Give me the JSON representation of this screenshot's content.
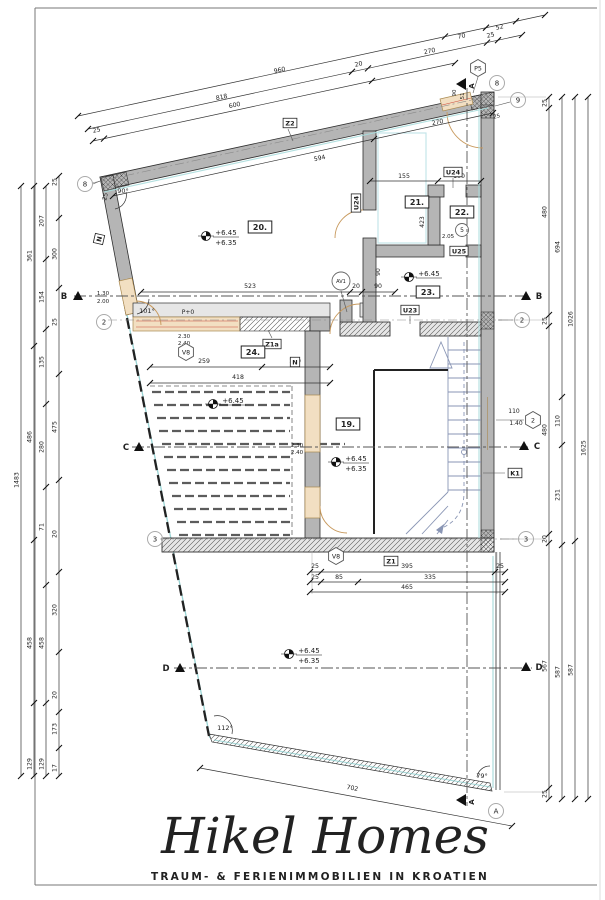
{
  "logo": {
    "name": "Hikel Homes",
    "tagline": "TRAUM- & FERIENIMMOBILIEN IN KROATIEN",
    "color": "#c6cc80"
  },
  "rooms": [
    {
      "t": "20.",
      "x": 260,
      "y": 227
    },
    {
      "t": "21.",
      "x": 417,
      "y": 202
    },
    {
      "t": "22.",
      "x": 462,
      "y": 212
    },
    {
      "t": "23.",
      "x": 428,
      "y": 292
    },
    {
      "t": "24.",
      "x": 253,
      "y": 352
    },
    {
      "t": "19.",
      "x": 348,
      "y": 424
    }
  ],
  "tag_boxes": [
    {
      "t": "Z2",
      "x": 290,
      "y": 123
    },
    {
      "t": "N",
      "x": 99,
      "y": 239,
      "r": -77
    },
    {
      "t": "U24",
      "x": 453,
      "y": 172
    },
    {
      "t": "U24",
      "x": 356,
      "y": 203,
      "r": -90
    },
    {
      "t": "U25",
      "x": 459,
      "y": 251
    },
    {
      "t": "U23",
      "x": 410,
      "y": 310
    },
    {
      "t": "Z1a",
      "x": 272,
      "y": 344
    },
    {
      "t": "N",
      "x": 295,
      "y": 362
    },
    {
      "t": "K1",
      "x": 515,
      "y": 473
    },
    {
      "t": "Z1",
      "x": 391,
      "y": 561
    }
  ],
  "bubbles": [
    {
      "t": "8",
      "x": 85,
      "y": 184
    },
    {
      "t": "8",
      "x": 497,
      "y": 83
    },
    {
      "t": "9",
      "x": 518,
      "y": 100
    },
    {
      "t": "2",
      "x": 104,
      "y": 322
    },
    {
      "t": "2",
      "x": 522,
      "y": 320
    },
    {
      "t": "3",
      "x": 155,
      "y": 539
    },
    {
      "t": "3",
      "x": 526,
      "y": 539
    },
    {
      "t": "A",
      "x": 496,
      "y": 811
    }
  ],
  "hexagons": [
    {
      "t": "P5",
      "x": 478,
      "y": 68
    },
    {
      "t": "V8",
      "x": 186,
      "y": 352
    },
    {
      "t": "V8",
      "x": 336,
      "y": 556
    },
    {
      "t": "2",
      "x": 533,
      "y": 420
    }
  ],
  "circles": [
    {
      "t": "5",
      "x": 462,
      "y": 230,
      "r": 6.5
    },
    {
      "t": "AV1",
      "x": 341,
      "y": 281,
      "r": 9
    }
  ],
  "elevations": [
    {
      "x": 206,
      "y": 236,
      "a": "+6.45",
      "b": "+6.35"
    },
    {
      "x": 409,
      "y": 277,
      "a": "+6.45"
    },
    {
      "x": 213,
      "y": 404,
      "a": "+6.45"
    },
    {
      "x": 336,
      "y": 462,
      "a": "+6.45",
      "b": "+6.35"
    },
    {
      "x": 289,
      "y": 654,
      "a": "+6.45",
      "b": "+6.35"
    }
  ],
  "sections": [
    {
      "l": "B",
      "tx": 64,
      "ty": 299,
      "ax": 78,
      "ay": 296
    },
    {
      "l": "B",
      "tx": 539,
      "ty": 299,
      "ax": 526,
      "ay": 296
    },
    {
      "l": "C",
      "tx": 126,
      "ty": 450,
      "ax": 139,
      "ay": 447
    },
    {
      "l": "C",
      "tx": 537,
      "ty": 449,
      "ax": 524,
      "ay": 446
    },
    {
      "l": "D",
      "tx": 166,
      "ty": 671,
      "ax": 180,
      "ay": 668
    },
    {
      "l": "D",
      "tx": 539,
      "ty": 670,
      "ax": 526,
      "ay": 667
    }
  ],
  "a_flags": [
    {
      "l": "A",
      "x": 467,
      "y": 84
    },
    {
      "l": "A",
      "x": 467,
      "y": 800
    }
  ],
  "angle_labels": [
    {
      "t": "90°",
      "x": 123,
      "y": 193,
      "s": 6.5
    },
    {
      "t": "101°",
      "x": 147,
      "y": 313,
      "s": 6.5
    },
    {
      "t": "112°",
      "x": 225,
      "y": 730,
      "s": 6.5
    },
    {
      "t": "79°",
      "x": 482,
      "y": 778,
      "s": 6.5
    }
  ],
  "texts": [
    {
      "t": "25",
      "x": 107,
      "y": 197,
      "s": 6,
      "r": -77
    },
    {
      "t": "1.30",
      "x": 103,
      "y": 295,
      "s": 5.5
    },
    {
      "t": "2.00",
      "x": 103,
      "y": 303,
      "s": 5.5
    },
    {
      "t": "P+0",
      "x": 188,
      "y": 314,
      "s": 6
    },
    {
      "t": "2.30",
      "x": 184,
      "y": 338,
      "s": 5.5
    },
    {
      "t": "2.40",
      "x": 184,
      "y": 345,
      "s": 5.5
    },
    {
      "t": "2.30",
      "x": 297,
      "y": 447,
      "s": 5.5
    },
    {
      "t": "2.40",
      "x": 297,
      "y": 454,
      "s": 5.5
    },
    {
      "t": "2.05",
      "x": 448,
      "y": 238,
      "s": 5.5
    },
    {
      "t": "110",
      "x": 514,
      "y": 413,
      "s": 6
    },
    {
      "t": "1.40",
      "x": 516,
      "y": 425,
      "s": 6
    },
    {
      "t": "90",
      "x": 380,
      "y": 272,
      "s": 6,
      "r": -90
    },
    {
      "t": "423",
      "x": 424,
      "y": 222,
      "s": 6,
      "r": -90
    },
    {
      "t": "90",
      "x": 456,
      "y": 93,
      "s": 5.5,
      "r": -90
    },
    {
      "t": "51",
      "x": 464,
      "y": 96,
      "s": 5.5,
      "r": -90
    },
    {
      "t": "25",
      "x": 497,
      "y": 118,
      "s": 5.5,
      "r": -12
    }
  ],
  "dims": {
    "vchains": [
      {
        "x": 21,
        "y1": 186,
        "y2": 776,
        "ticks": [
          186,
          776
        ],
        "labels": [
          {
            "t": "1483",
            "y": 480
          }
        ]
      },
      {
        "x": 34,
        "y1": 186,
        "y2": 776,
        "ticks": [
          186,
          346,
          540,
          703,
          776
        ],
        "labels": [
          {
            "t": "361",
            "y": 256
          },
          {
            "t": "486",
            "y": 437
          },
          {
            "t": "458",
            "y": 643
          },
          {
            "t": "129",
            "y": 764
          }
        ]
      },
      {
        "x": 46,
        "y1": 186,
        "y2": 776,
        "ticks": [
          186,
          259,
          329,
          404,
          487,
          585,
          703,
          776
        ],
        "labels": [
          {
            "t": "207",
            "y": 221
          },
          {
            "t": "154",
            "y": 297
          },
          {
            "t": "135",
            "y": 362
          },
          {
            "t": "280",
            "y": 447
          },
          {
            "t": "71",
            "y": 527
          },
          {
            "t": "458",
            "y": 643
          },
          {
            "t": "129",
            "y": 764
          }
        ]
      },
      {
        "x": 59,
        "y1": 176,
        "y2": 776,
        "ticks": [
          176,
          218,
          288,
          374,
          480,
          572,
          652,
          712,
          748,
          776
        ],
        "labels": [
          {
            "t": "25",
            "y": 182
          },
          {
            "t": "300",
            "y": 254
          },
          {
            "t": "25",
            "y": 322
          },
          {
            "t": "475",
            "y": 427
          },
          {
            "t": "20",
            "y": 534
          },
          {
            "t": "320",
            "y": 610
          },
          {
            "t": "20",
            "y": 695
          },
          {
            "t": "173",
            "y": 729
          },
          {
            "t": "17",
            "y": 768
          }
        ]
      },
      {
        "x": 549,
        "y1": 97,
        "y2": 799,
        "ticks": [
          97,
          108,
          315,
          326,
          534,
          543,
          788,
          799
        ],
        "labels": [
          {
            "t": "25",
            "y": 103
          },
          {
            "t": "480",
            "y": 212
          },
          {
            "t": "25",
            "y": 321
          },
          {
            "t": "480",
            "y": 430
          },
          {
            "t": "20",
            "y": 539
          },
          {
            "t": "567",
            "y": 666
          },
          {
            "t": "25",
            "y": 794
          }
        ]
      },
      {
        "x": 562,
        "y1": 97,
        "y2": 799,
        "ticks": [
          97,
          397,
          445,
          545,
          799
        ],
        "labels": [
          {
            "t": "694",
            "y": 247
          },
          {
            "t": "110",
            "y": 421
          },
          {
            "t": "231",
            "y": 495
          },
          {
            "t": "587",
            "y": 672
          }
        ]
      },
      {
        "x": 575,
        "y1": 97,
        "y2": 799,
        "ticks": [
          97,
          541,
          799
        ],
        "labels": [
          {
            "t": "1026",
            "y": 319
          },
          {
            "t": "587",
            "y": 670
          }
        ]
      },
      {
        "x": 588,
        "y1": 97,
        "y2": 799,
        "ticks": [
          97,
          799
        ],
        "labels": [
          {
            "t": "1625",
            "y": 448
          }
        ]
      }
    ],
    "rows": [
      {
        "x1": 78,
        "y1": 116,
        "x2": 545,
        "y2": 15,
        "lrot": -12.2,
        "ticks": [
          [
            78,
            116
          ],
          [
            445,
            36.5
          ],
          [
            486,
            27.7
          ],
          [
            516,
            21.2
          ],
          [
            545,
            15
          ]
        ],
        "labels": [
          {
            "t": "960",
            "x": 280,
            "y": 72
          },
          {
            "t": "70",
            "x": 462,
            "y": 38
          },
          {
            "t": "52",
            "x": 500,
            "y": 29
          }
        ]
      },
      {
        "x1": 88,
        "y1": 129,
        "x2": 522,
        "y2": 35,
        "lrot": -12.2,
        "ticks": [
          [
            88,
            129
          ],
          [
            352,
            71.8
          ],
          [
            368,
            68.4
          ],
          [
            487,
            42.6
          ],
          [
            498,
            40.2
          ],
          [
            522,
            35
          ]
        ],
        "labels": [
          {
            "t": "818",
            "x": 222,
            "y": 99
          },
          {
            "t": "20",
            "x": 359,
            "y": 66
          },
          {
            "t": "270",
            "x": 430,
            "y": 53
          },
          {
            "t": "25",
            "x": 491,
            "y": 37
          }
        ]
      },
      {
        "x1": 93,
        "y1": 141,
        "x2": 455,
        "y2": 63,
        "lrot": -12.2,
        "ticks": [
          [
            93,
            141
          ],
          [
            104,
            138.6
          ],
          [
            372,
            80.9
          ],
          [
            455,
            63
          ]
        ],
        "labels": [
          {
            "t": "25",
            "x": 97,
            "y": 132
          },
          {
            "t": "600",
            "x": 235,
            "y": 107
          }
        ]
      },
      {
        "x1": 113,
        "y1": 196,
        "x2": 493,
        "y2": 113,
        "lrot": -12.2,
        "ticks": [
          [
            113,
            196
          ],
          [
            374,
            139
          ],
          [
            493,
            113
          ]
        ],
        "labels": [
          {
            "t": "594",
            "x": 320,
            "y": 160
          },
          {
            "t": "270",
            "x": 438,
            "y": 124
          }
        ]
      },
      {
        "x1": 370,
        "y1": 181,
        "x2": 481,
        "y2": 181,
        "ticks": [
          [
            370,
            181
          ],
          [
            438,
            181
          ],
          [
            481,
            181
          ]
        ],
        "labels": [
          {
            "t": "155",
            "x": 404,
            "y": 178
          },
          {
            "t": "100",
            "x": 459,
            "y": 178
          }
        ]
      },
      {
        "x1": 141,
        "y1": 292,
        "x2": 395,
        "y2": 292,
        "ticks": [
          [
            141,
            292
          ],
          [
            350,
            292
          ],
          [
            362,
            292
          ],
          [
            395,
            292
          ]
        ],
        "labels": [
          {
            "t": "523",
            "x": 250,
            "y": 288
          },
          {
            "t": "20",
            "x": 356,
            "y": 288
          },
          {
            "t": "90",
            "x": 378,
            "y": 288
          }
        ]
      },
      {
        "x1": 150,
        "y1": 367,
        "x2": 330,
        "y2": 367,
        "ticks": [
          [
            150,
            367
          ],
          [
            262,
            367
          ],
          [
            330,
            367
          ]
        ],
        "labels": [
          {
            "t": "259",
            "x": 204,
            "y": 363
          },
          {
            "t": "159",
            "x": 295,
            "y": 363
          }
        ]
      },
      {
        "x1": 150,
        "y1": 383,
        "x2": 330,
        "y2": 383,
        "ticks": [
          [
            150,
            383
          ],
          [
            330,
            383
          ]
        ],
        "labels": [
          {
            "t": "418",
            "x": 238,
            "y": 379
          }
        ]
      },
      {
        "x1": 310,
        "y1": 572,
        "x2": 505,
        "y2": 572,
        "ticks": [
          [
            310,
            572
          ],
          [
            321,
            572
          ],
          [
            495,
            572
          ],
          [
            505,
            572
          ]
        ],
        "labels": [
          {
            "t": "25",
            "x": 315,
            "y": 568
          },
          {
            "t": "395",
            "x": 407,
            "y": 568
          },
          {
            "t": "25",
            "x": 500,
            "y": 568
          }
        ]
      },
      {
        "x1": 310,
        "y1": 582,
        "x2": 505,
        "y2": 582,
        "ticks": [
          [
            310,
            582
          ],
          [
            321,
            582
          ],
          [
            358,
            582
          ],
          [
            505,
            582
          ]
        ],
        "labels": [
          {
            "t": "25",
            "x": 315,
            "y": 579
          },
          {
            "t": "85",
            "x": 339,
            "y": 579
          },
          {
            "t": "335",
            "x": 430,
            "y": 579
          }
        ]
      },
      {
        "x1": 310,
        "y1": 592,
        "x2": 505,
        "y2": 592,
        "ticks": [
          [
            310,
            592
          ],
          [
            505,
            592
          ]
        ],
        "labels": [
          {
            "t": "465",
            "x": 407,
            "y": 589
          }
        ]
      },
      {
        "x1": 200,
        "y1": 768,
        "x2": 512,
        "y2": 826,
        "lrot": 10.6,
        "ticks": [
          [
            200,
            768
          ],
          [
            512,
            826
          ]
        ],
        "labels": [
          {
            "t": "702",
            "x": 352,
            "y": 790
          }
        ]
      }
    ]
  }
}
